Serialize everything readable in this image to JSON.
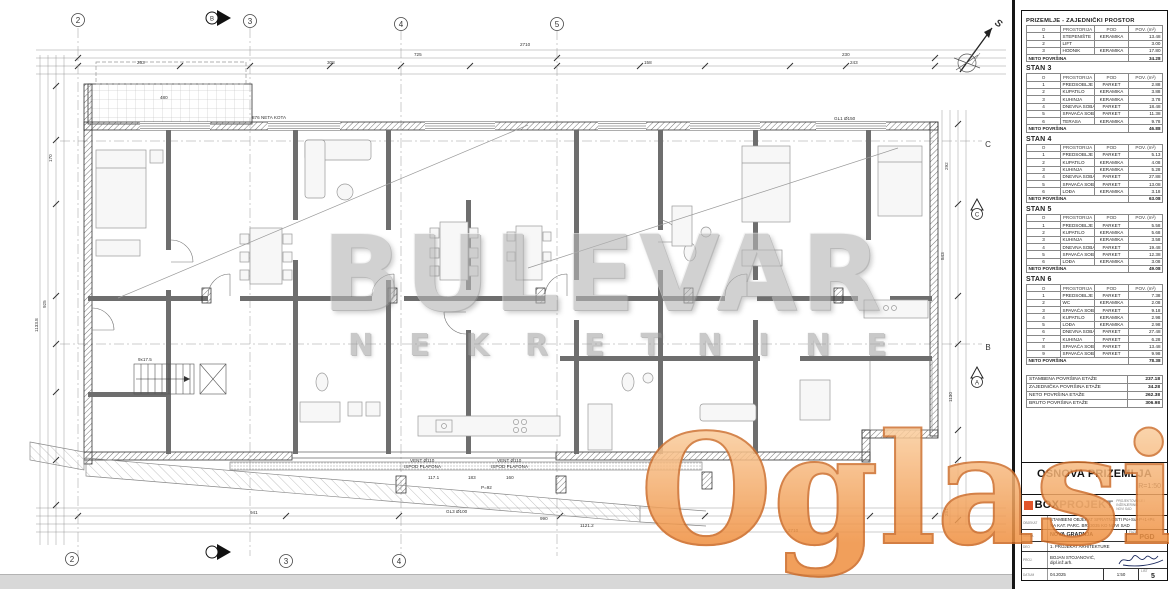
{
  "watermarks": {
    "brand": "BULEVAR",
    "brand_sub": "NEKRETNINE",
    "overlay": "Oglasi",
    "overlay_suffix": ".rs"
  },
  "colors": {
    "overlay_orange": "#ef8f3f",
    "overlay_gray": "#a2a2a2",
    "logo_red": "#e2552b",
    "line": "#444444"
  },
  "plan": {
    "north_label": "S",
    "grid": {
      "top": [
        "2",
        "3",
        "4",
        "5"
      ],
      "bottom": [
        "2",
        "3",
        "4"
      ],
      "right_letters": [
        "C",
        "B"
      ],
      "section_letters": [
        "C",
        "A"
      ],
      "section_marker": "B"
    },
    "annotations": [
      {
        "text": "2710",
        "x": 520,
        "y": 46
      },
      {
        "text": "725",
        "x": 414,
        "y": 56
      },
      {
        "text": "230",
        "x": 842,
        "y": 56
      },
      {
        "text": "263",
        "x": 137,
        "y": 64
      },
      {
        "text": "308",
        "x": 327,
        "y": 64
      },
      {
        "text": "158",
        "x": 644,
        "y": 64
      },
      {
        "text": "243",
        "x": 850,
        "y": 64
      },
      {
        "text": "480",
        "x": 160,
        "y": 99
      },
      {
        "text": "876 NETA KOTA",
        "x": 252,
        "y": 119
      },
      {
        "text": "GL1 Ø150",
        "x": 834,
        "y": 120
      },
      {
        "text": "9x17.5",
        "x": 138,
        "y": 361
      },
      {
        "text": "VENT Ø110",
        "x": 410,
        "y": 462
      },
      {
        "text": "ISPOD PLAFONA",
        "x": 404,
        "y": 468
      },
      {
        "text": "VENT Ø110",
        "x": 497,
        "y": 462
      },
      {
        "text": "ISPOD PLAFONA",
        "x": 491,
        "y": 468
      },
      {
        "text": "117.1",
        "x": 428,
        "y": 479
      },
      {
        "text": "183",
        "x": 468,
        "y": 479
      },
      {
        "text": "160",
        "x": 506,
        "y": 479
      },
      {
        "text": "P=92",
        "x": 481,
        "y": 489
      },
      {
        "text": "GL3 Ø100",
        "x": 446,
        "y": 513
      },
      {
        "text": "941",
        "x": 250,
        "y": 514
      },
      {
        "text": "990",
        "x": 540,
        "y": 520
      },
      {
        "text": "1121.2",
        "x": 580,
        "y": 527
      },
      {
        "text": "2710",
        "x": 788,
        "y": 532
      },
      {
        "text": "170",
        "x": 52,
        "y": 162,
        "rot": -90
      },
      {
        "text": "925",
        "x": 46,
        "y": 308,
        "rot": -90
      },
      {
        "text": "1133.8",
        "x": 38,
        "y": 332,
        "rot": -90
      },
      {
        "text": "292",
        "x": 948,
        "y": 170,
        "rot": -90
      },
      {
        "text": "843",
        "x": 944,
        "y": 260,
        "rot": -90
      },
      {
        "text": "1130",
        "x": 952,
        "y": 402,
        "rot": -90
      },
      {
        "text": "281",
        "x": 948,
        "y": 516,
        "rot": -90
      }
    ]
  },
  "panel": {
    "columns": [
      "O",
      "PROSTORIJA",
      "POD",
      "POV. (m²)"
    ],
    "neto_label": "NETO POVRŠINA",
    "tables": [
      {
        "title": "PRIZEMLJE - ZAJEDNIČKI PROSTOR",
        "rows": [
          [
            "1",
            "STEPENIŠTE",
            "KERAMIKA",
            "13.48"
          ],
          [
            "2",
            "LIFT",
            "",
            "3.00"
          ],
          [
            "3",
            "HODNIK",
            "KERAMIKA",
            "17.80"
          ]
        ],
        "neto": "34.28"
      },
      {
        "title": "STAN 3",
        "rows": [
          [
            "1",
            "PREDSOBLJE",
            "PARKET",
            "2.88"
          ],
          [
            "2",
            "KUPATILO",
            "KERAMIKA",
            "3.88"
          ],
          [
            "3",
            "KUHINJA",
            "KERAMIKA",
            "3.78"
          ],
          [
            "4",
            "DNEVNA SOBA",
            "PARKET",
            "18.48"
          ],
          [
            "5",
            "SPAVAĆA SOBA",
            "PARKET",
            "11.38"
          ],
          [
            "6",
            "TERASA",
            "KERAMIKA",
            "9.78"
          ]
        ],
        "neto": "46.88"
      },
      {
        "title": "STAN 4",
        "rows": [
          [
            "1",
            "PREDSOBLJE",
            "PARKET",
            "5.13"
          ],
          [
            "2",
            "KUPATILO",
            "KERAMIKA",
            "4.08"
          ],
          [
            "3",
            "KUHINJA",
            "KERAMIKA",
            "5.28"
          ],
          [
            "4",
            "DNEVNA SOBA",
            "PARKET",
            "27.88"
          ],
          [
            "5",
            "SPAVAĆA SOBA",
            "PARKET",
            "13.08"
          ],
          [
            "6",
            "LOĐA",
            "KERAMIKA",
            "3.18"
          ]
        ],
        "neto": "63.08"
      },
      {
        "title": "STAN 5",
        "rows": [
          [
            "1",
            "PREDSOBLJE",
            "PARKET",
            "5.58"
          ],
          [
            "2",
            "KUPATILO",
            "KERAMIKA",
            "5.68"
          ],
          [
            "3",
            "KUHINJA",
            "KERAMIKA",
            "3.58"
          ],
          [
            "4",
            "DNEVNA SOBA",
            "PARKET",
            "19.48"
          ],
          [
            "5",
            "SPAVAĆA SOBA",
            "PARKET",
            "12.38"
          ],
          [
            "6",
            "LOĐA",
            "KERAMIKA",
            "3.08"
          ]
        ],
        "neto": "49.08"
      },
      {
        "title": "STAN 6",
        "rows": [
          [
            "1",
            "PREDSOBLJE",
            "PARKET",
            "7.38"
          ],
          [
            "2",
            "WC",
            "KERAMIKA",
            "2.08"
          ],
          [
            "3",
            "SPAVAĆA SOBA",
            "PARKET",
            "9.18"
          ],
          [
            "4",
            "KUPATILO",
            "KERAMIKA",
            "2.98"
          ],
          [
            "5",
            "LOĐA",
            "KERAMIKA",
            "2.98"
          ],
          [
            "6",
            "DNEVNA SOBA",
            "PARKET",
            "27.48"
          ],
          [
            "7",
            "KUHINJA",
            "PARKET",
            "6.28"
          ],
          [
            "8",
            "SPAVAĆA SOBA",
            "PARKET",
            "13.48"
          ],
          [
            "9",
            "SPAVAĆA SOBA",
            "PARKET",
            "9.98"
          ]
        ],
        "neto": "78.38"
      }
    ],
    "summary": [
      [
        "STAMBENA POVRŠINA ETAŽE",
        "237.18"
      ],
      [
        "ZAJEDNIČKA POVRŠINA ETAŽE",
        "34.28"
      ],
      [
        "NETO POVRŠINA ETAŽE",
        "262.38"
      ],
      [
        "BRUTO POVRŠINA ETAŽE",
        "306.98"
      ]
    ],
    "title_block": {
      "drawing_title": "OSNOVA PRIZEMLJA",
      "scale": "R=1:50",
      "logo_box": "BOX",
      "logo_projekt": "PROJEKT",
      "logo_sub1": "PROJEKTOVANJE I INŽENJERING",
      "logo_sub2": "NOVI SAD",
      "object_label": "OBJEKAT",
      "object_line1": "STAMBENI OBJEKAT SPRATNOSTI Po+Su+P+1+Ps",
      "object_line2": "NA KAT. PARC. BR. 3035 KO NOVI SAD",
      "type_label": "VRSTA",
      "type_value": "NOVA GRADNJA",
      "phase_label": "FAZA",
      "phase_value": "PGD",
      "part_label": "DEO",
      "part_value": "1. PROJEKAT ARHITEKTURE",
      "designer_label": "PROJ.",
      "designer_value": "BOJAN STOJANOVIĆ, dipl.inž.arh.",
      "date_label": "DATUM",
      "date_value": "04.2025",
      "scale_short": "1:50",
      "sheet_label": "LIST",
      "sheet_no": "5"
    }
  }
}
